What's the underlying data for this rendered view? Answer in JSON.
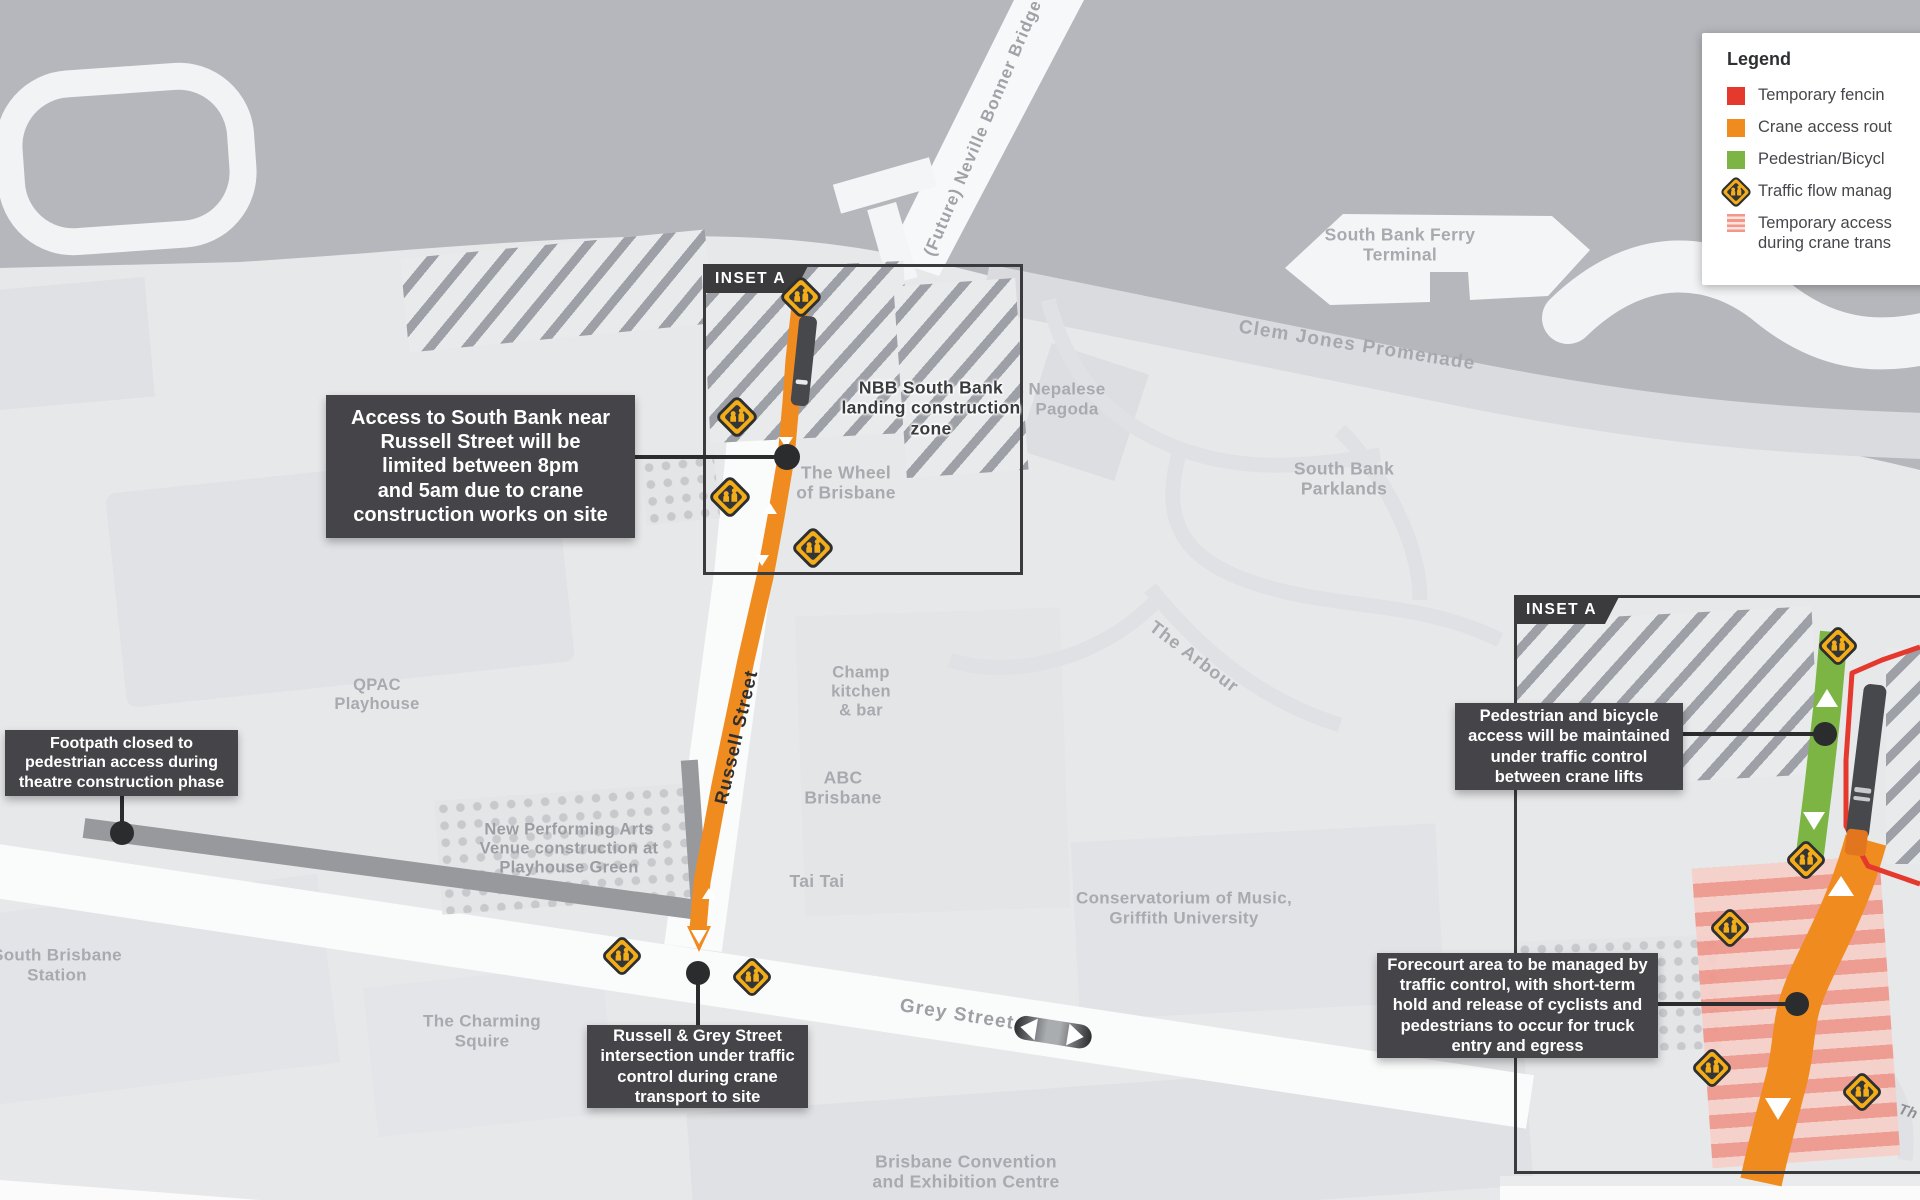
{
  "legend": {
    "title": "Legend",
    "items": [
      {
        "swatch": "red-square",
        "label": "Temporary fencin"
      },
      {
        "swatch": "orange-square",
        "label": "Crane access rout"
      },
      {
        "swatch": "green-square",
        "label": "Pedestrian/Bicycl"
      },
      {
        "swatch": "traffic-management-icon",
        "label": "Traffic flow manag"
      },
      {
        "swatch": "pink-stripe-square",
        "label": "Temporary access",
        "label2": "during crane trans"
      }
    ]
  },
  "insets": {
    "main_label": "INSET A",
    "detail_label": "INSET A"
  },
  "callouts": {
    "access": {
      "lines": [
        "Access to South Bank near",
        "Russell Street will be",
        "limited between 8pm",
        "and 5am due to crane",
        "construction works on site"
      ]
    },
    "footpath": {
      "lines": [
        "Footpath closed to",
        "pedestrian access during",
        "theatre construction phase"
      ]
    },
    "intersection": {
      "lines": [
        "Russell & Grey Street",
        "intersection under traffic",
        "control during crane",
        "transport to site"
      ]
    },
    "pedestrian": {
      "lines": [
        "Pedestrian and bicycle",
        "access will be maintained",
        "under traffic control",
        "between crane lifts"
      ]
    },
    "forecourt": {
      "lines": [
        "Forecourt area to be managed by",
        "traffic control, with short-term",
        "hold and release of cyclists and",
        "pedestrians to occur for truck",
        "entry and egress"
      ]
    }
  },
  "map_labels": {
    "bridge": {
      "lines": [
        "(Future) Neville Bonner Bridge"
      ]
    },
    "nbb": {
      "lines": [
        "NBB South Bank",
        "landing construction",
        "zone"
      ]
    },
    "wheel": {
      "lines": [
        "The Wheel",
        "of Brisbane"
      ]
    },
    "nepalese": {
      "lines": [
        "Nepalese",
        "Pagoda"
      ]
    },
    "ferry": {
      "lines": [
        "South Bank Ferry",
        "Terminal"
      ]
    },
    "clem": {
      "lines": [
        "Clem Jones Promenade"
      ]
    },
    "parklands": {
      "lines": [
        "South Bank",
        "Parklands"
      ]
    },
    "arbour": {
      "lines": [
        "The Arbour"
      ]
    },
    "qpac": {
      "lines": [
        "QPAC",
        "Playhouse"
      ]
    },
    "russell": {
      "lines": [
        "Russell Street"
      ]
    },
    "champ": {
      "lines": [
        "Champ",
        "kitchen",
        "& bar"
      ]
    },
    "abc": {
      "lines": [
        "ABC",
        "Brisbane"
      ]
    },
    "taitai": {
      "lines": [
        "Tai Tai"
      ]
    },
    "npav": {
      "lines": [
        "New Performing Arts",
        "Venue construction at",
        "Playhouse Green"
      ]
    },
    "conservatorium": {
      "lines": [
        "Conservatorium of Music,",
        "Griffith University"
      ]
    },
    "station": {
      "lines": [
        "South Brisbane",
        "Station"
      ]
    },
    "charming": {
      "lines": [
        "The Charming",
        "Squire"
      ]
    },
    "grey": {
      "lines": [
        "Grey Street"
      ]
    },
    "convention": {
      "lines": [
        "Brisbane Convention",
        "and Exhibition Centre"
      ]
    },
    "edge_fragment": {
      "lines": [
        "Th"
      ]
    }
  },
  "colors": {
    "crane_access_route": "#f08b1f",
    "temporary_fencing": "#e6392e",
    "pedestrian_bicycle_route": "#7cb544",
    "temporary_access_stripes": "#ef978c",
    "traffic_sign_yellow": "#f3ad19",
    "callout_background": "#454449",
    "river": "#b5b7bc",
    "land": "#e7e8ea"
  }
}
